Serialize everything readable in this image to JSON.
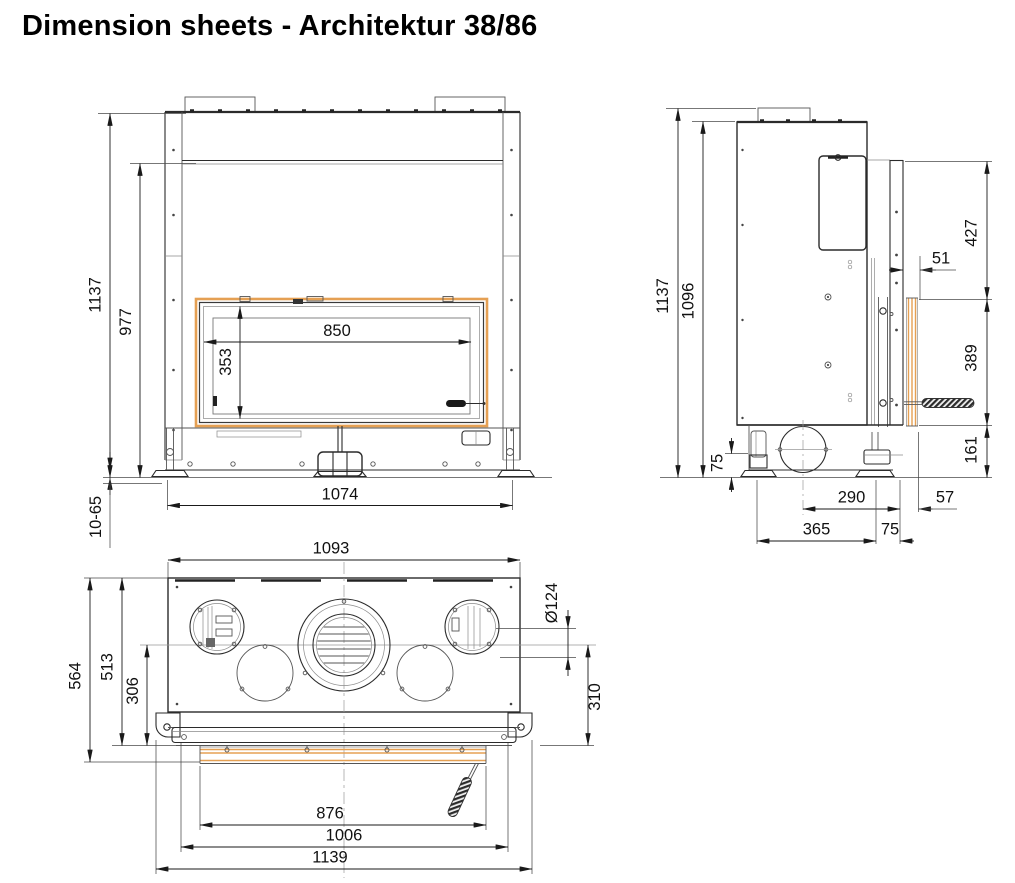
{
  "title": "Dimension sheets - Architektur 38/86",
  "colors": {
    "accent_orange": "#EE8000",
    "frame_orange": "#E5A053",
    "line": "#2b2b2b"
  },
  "views": {
    "front": {
      "overall_height": "1137",
      "frame_height": "977",
      "glass_width": "850",
      "glass_height": "353",
      "base_width": "1074",
      "foot_adjustment": "10-65"
    },
    "side": {
      "overall_height": "1137",
      "body_height": "1096",
      "upper_front_height": "427",
      "door_frame_depth": "51",
      "door_height": "389",
      "lower_front_height": "161",
      "base_foot_height": "75",
      "flue_center_to_front": "290",
      "front_overhang": "57",
      "foot_spacing": "365",
      "foot_to_front": "75"
    },
    "top": {
      "body_width": "1093",
      "connection_diameter": "Ø124",
      "overall_depth": "564",
      "body_depth": "513",
      "center_to_front": "306",
      "center_to_door": "310",
      "door_width": "876",
      "front_frame_width": "1006",
      "overall_width": "1139"
    }
  }
}
